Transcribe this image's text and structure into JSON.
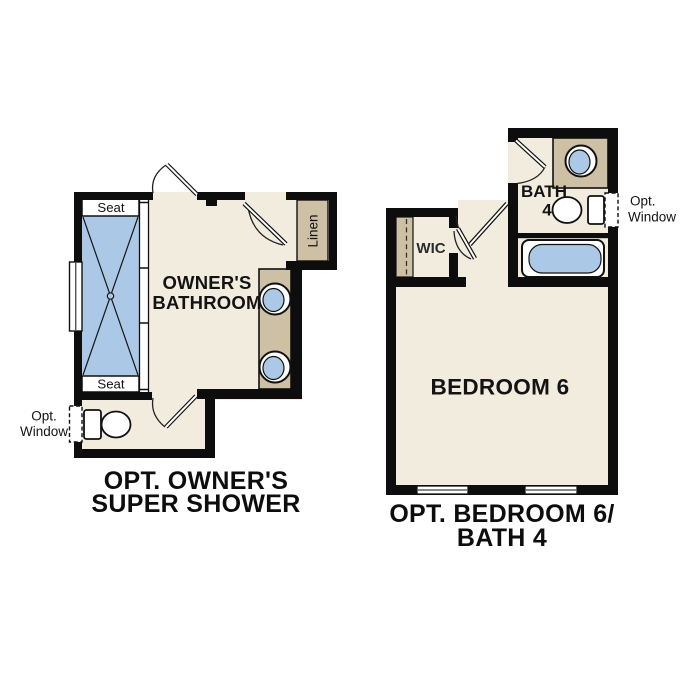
{
  "colors": {
    "wall": "#0d0d0d",
    "floor": "#f2ecdf",
    "fixture_tan": "#cec0a5",
    "water_blue": "#abc8e6",
    "outline": "#111111"
  },
  "left_plan": {
    "title_line1": "OPT. OWNER'S",
    "title_line2": "SUPER SHOWER",
    "room_label_line1": "OWNER'S",
    "room_label_line2": "BATHROOM",
    "shower_seat_top": "Seat",
    "shower_seat_bottom": "Seat",
    "linen_label": "Linen",
    "opt_window_line1": "Opt.",
    "opt_window_line2": "Window"
  },
  "right_plan": {
    "title_line1": "OPT. BEDROOM 6/",
    "title_line2": "BATH 4",
    "bedroom_label": "BEDROOM 6",
    "bath_label_line1": "BATH",
    "bath_label_line2": "4",
    "wic_label": "WIC",
    "opt_window_line1": "Opt.",
    "opt_window_line2": "Window"
  }
}
